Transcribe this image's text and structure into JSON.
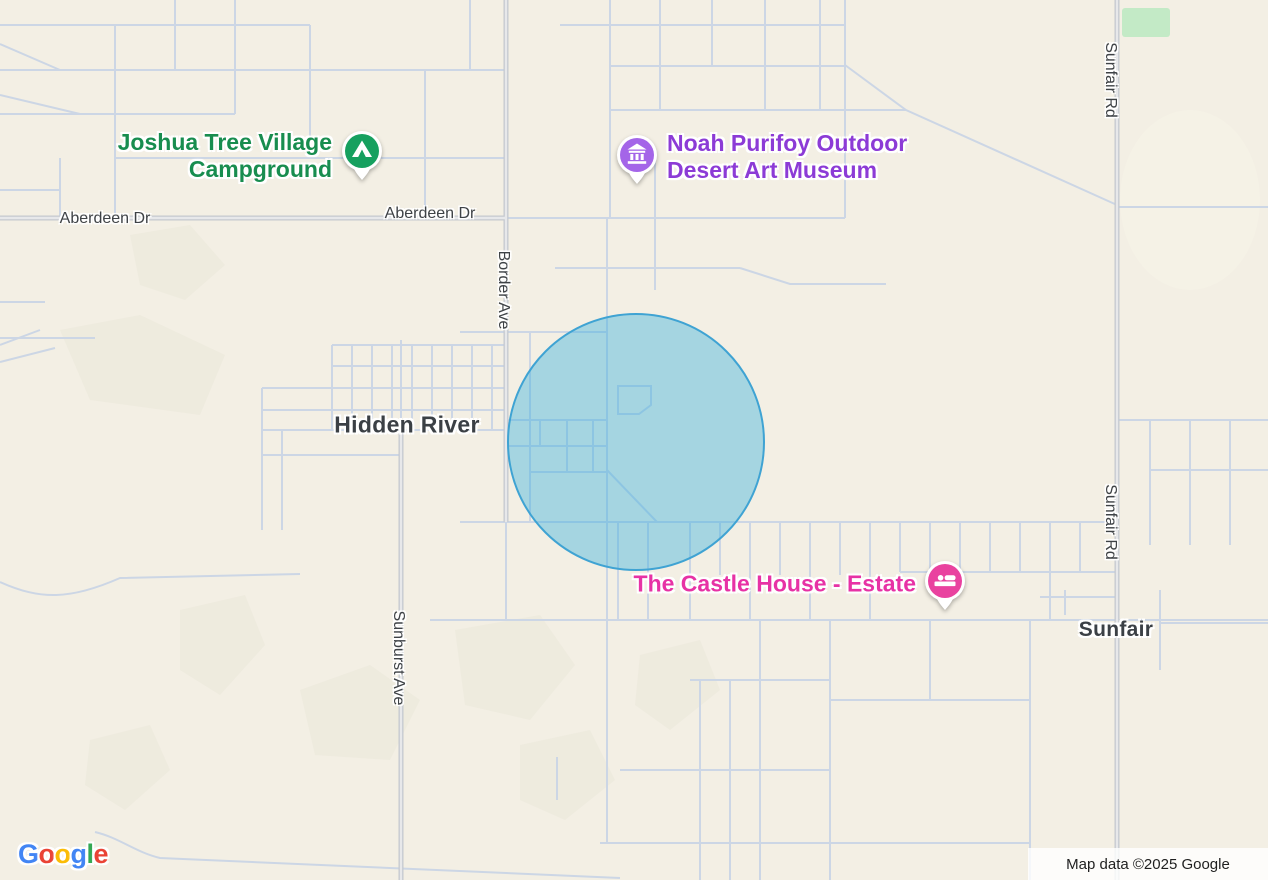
{
  "map": {
    "background_color": "#f3efe4",
    "colors": {
      "road_thin": "#ccd6e5",
      "road_main_casing": "#c4c8ce",
      "road_main_core": "#e7e8ea",
      "terrain": "#ebe8da",
      "park": "#c3eac6",
      "label_dark": "#3b4045",
      "road_label": "#3e4246"
    },
    "accuracy_circle": {
      "cx": 634,
      "cy": 440,
      "r": 127,
      "fill": "rgba(40,170,220,0.38)",
      "stroke": "#3fa3d3"
    },
    "park_area": {
      "x": 1122,
      "y": 8,
      "width": 48,
      "height": 29
    },
    "markers": [
      {
        "id": "campground",
        "name": "Joshua Tree Village Campground",
        "icon": "tent-icon",
        "pin_color": "#16a05f",
        "label_color": "#188d4f",
        "pin_x": 362,
        "pin_y": 151,
        "label_side": "left",
        "label_x": 332,
        "label_y": 156,
        "lines": [
          "Joshua Tree Village",
          "Campground"
        ]
      },
      {
        "id": "museum",
        "name": "Noah Purifoy Outdoor Desert Art Museum",
        "icon": "museum-icon",
        "pin_color": "#a465e8",
        "label_color": "#8c3bd6",
        "pin_x": 637,
        "pin_y": 155,
        "label_side": "right",
        "label_x": 667,
        "label_y": 157,
        "lines": [
          "Noah Purifoy Outdoor",
          "Desert Art Museum"
        ]
      },
      {
        "id": "lodging",
        "name": "The Castle House - Estate",
        "icon": "bed-icon",
        "pin_color": "#e9429f",
        "label_color": "#e732a5",
        "pin_x": 945,
        "pin_y": 581,
        "label_side": "left",
        "label_x": 916,
        "label_y": 584,
        "lines": [
          "The Castle House - Estate"
        ]
      }
    ],
    "place_labels": [
      {
        "text": "Hidden River",
        "x": 407,
        "y": 425,
        "size": 23
      },
      {
        "text": "Sunfair",
        "x": 1116,
        "y": 630,
        "size": 21
      }
    ],
    "road_labels": [
      {
        "text": "Aberdeen Dr",
        "x": 105,
        "y": 219,
        "rot": 0
      },
      {
        "text": "Aberdeen Dr",
        "x": 430,
        "y": 214,
        "rot": 0
      },
      {
        "text": "Border Ave",
        "x": 503,
        "y": 290,
        "rot": 90
      },
      {
        "text": "Sunburst Ave",
        "x": 398,
        "y": 658,
        "rot": 90
      },
      {
        "text": "Sunfair Rd",
        "x": 1110,
        "y": 80,
        "rot": 90
      },
      {
        "text": "Sunfair Rd",
        "x": 1110,
        "y": 522,
        "rot": 90
      }
    ],
    "attribution": "Map data ©2025 Google",
    "logo_letters": [
      {
        "ch": "G",
        "color": "#4285F4"
      },
      {
        "ch": "o",
        "color": "#EA4335"
      },
      {
        "ch": "o",
        "color": "#FBBC05"
      },
      {
        "ch": "g",
        "color": "#4285F4"
      },
      {
        "ch": "l",
        "color": "#34A853"
      },
      {
        "ch": "e",
        "color": "#EA4335"
      }
    ]
  }
}
